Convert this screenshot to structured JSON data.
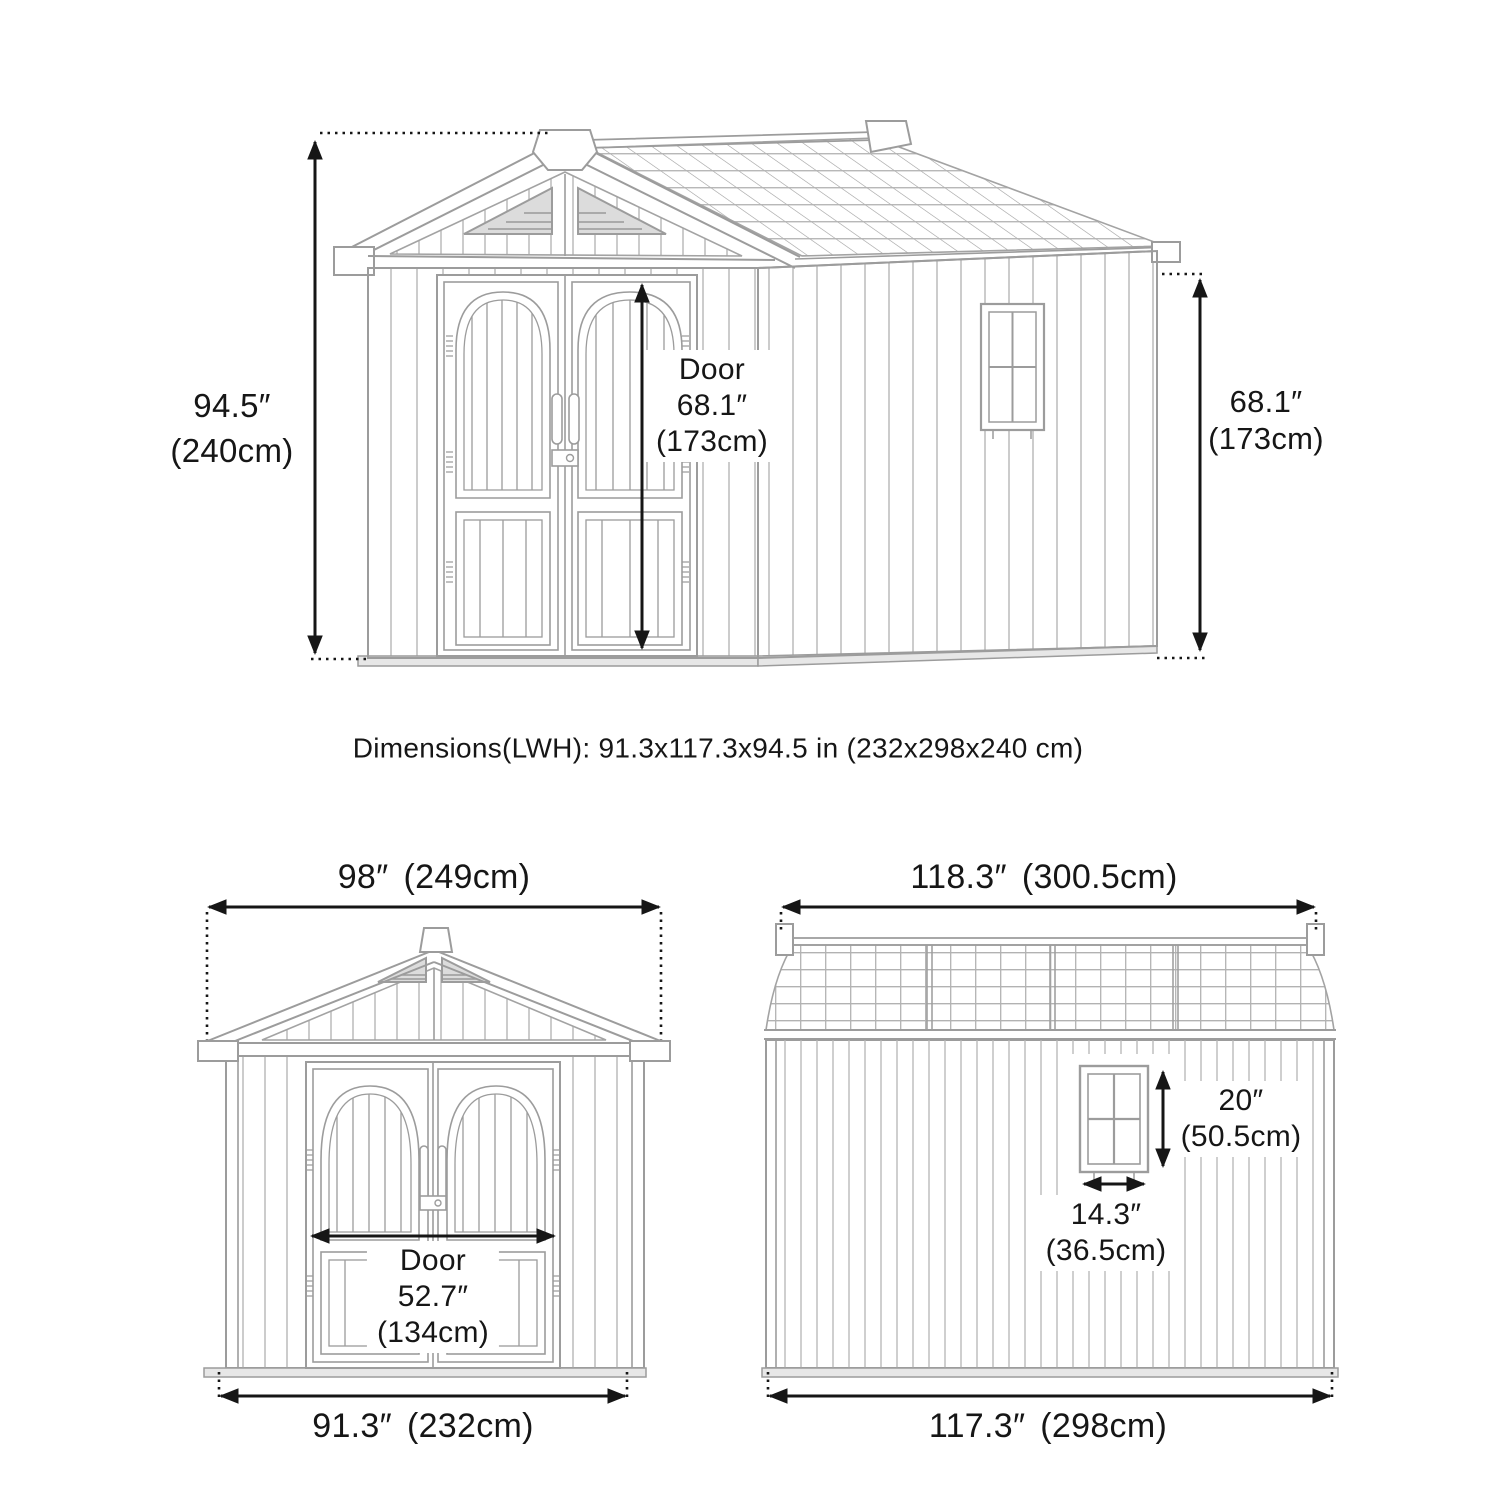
{
  "summary": {
    "dimensions_line": "Dimensions(LWH): 91.3x117.3x94.5 in (232x298x240 cm)"
  },
  "perspective_view": {
    "overall_height_in": "94.5″",
    "overall_height_cm": "(240cm)",
    "door_title": "Door",
    "door_height_in": "68.1″",
    "door_height_cm": "(173cm)",
    "wall_height_in": "68.1″",
    "wall_height_cm": "(173cm)"
  },
  "front_view": {
    "roof_width_in": "98″",
    "roof_width_cm": "(249cm)",
    "door_title": "Door",
    "door_width_in": "52.7″",
    "door_width_cm": "(134cm)",
    "base_width_in": "91.3″",
    "base_width_cm": "(232cm)"
  },
  "side_view": {
    "roof_length_in": "118.3″",
    "roof_length_cm": "(300.5cm)",
    "window_height_in": "20″",
    "window_height_cm": "(50.5cm)",
    "window_width_in": "14.3″",
    "window_width_cm": "(36.5cm)",
    "base_length_in": "117.3″",
    "base_length_cm": "(298cm)"
  },
  "colors": {
    "line_art": "#9c9c9c",
    "line_art_light": "#b5b5b5",
    "dimension": "#161616",
    "background": "#ffffff"
  }
}
